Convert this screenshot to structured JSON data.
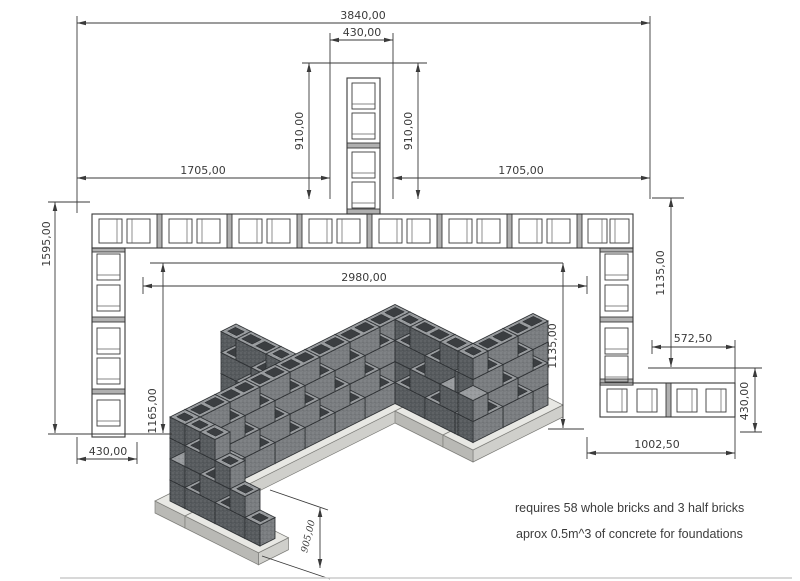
{
  "drawing": {
    "dimensions": {
      "overall_width": "3840,00",
      "pier_width": "430,00",
      "pier_length_left": "910,00",
      "pier_length_right": "910,00",
      "left_span": "1705,00",
      "right_span": "1705,00",
      "left_side_length": "1595,00",
      "inner_width": "2980,00",
      "left_inner_length": "1165,00",
      "left_wall_width": "430,00",
      "right_inner_length": "1135,00",
      "right_outer_length": "1135,00",
      "right_inset": "572,50",
      "right_wing_width": "430,00",
      "right_wing_length": "1002,50",
      "wall_height": "905,00"
    },
    "notes": {
      "bricks": "requires 58 whole bricks and 3 half bricks",
      "concrete": "aprox 0.5m^3 of concrete for foundations"
    },
    "colors": {
      "line": "#3a3a3a",
      "mortar": "#b0b0b0",
      "block_face_s": "#797c7f",
      "block_face_w": "#565a5d",
      "block_top": "#989b9e",
      "block_core": "#3b3e41",
      "block_joint": "#2d3033",
      "foundation_top": "#e8e8e4",
      "foundation_front": "#cfcfcb",
      "foundation_side": "#b9b9b5",
      "foundation_edge": "#7d7d79",
      "background": "#ffffff"
    }
  }
}
